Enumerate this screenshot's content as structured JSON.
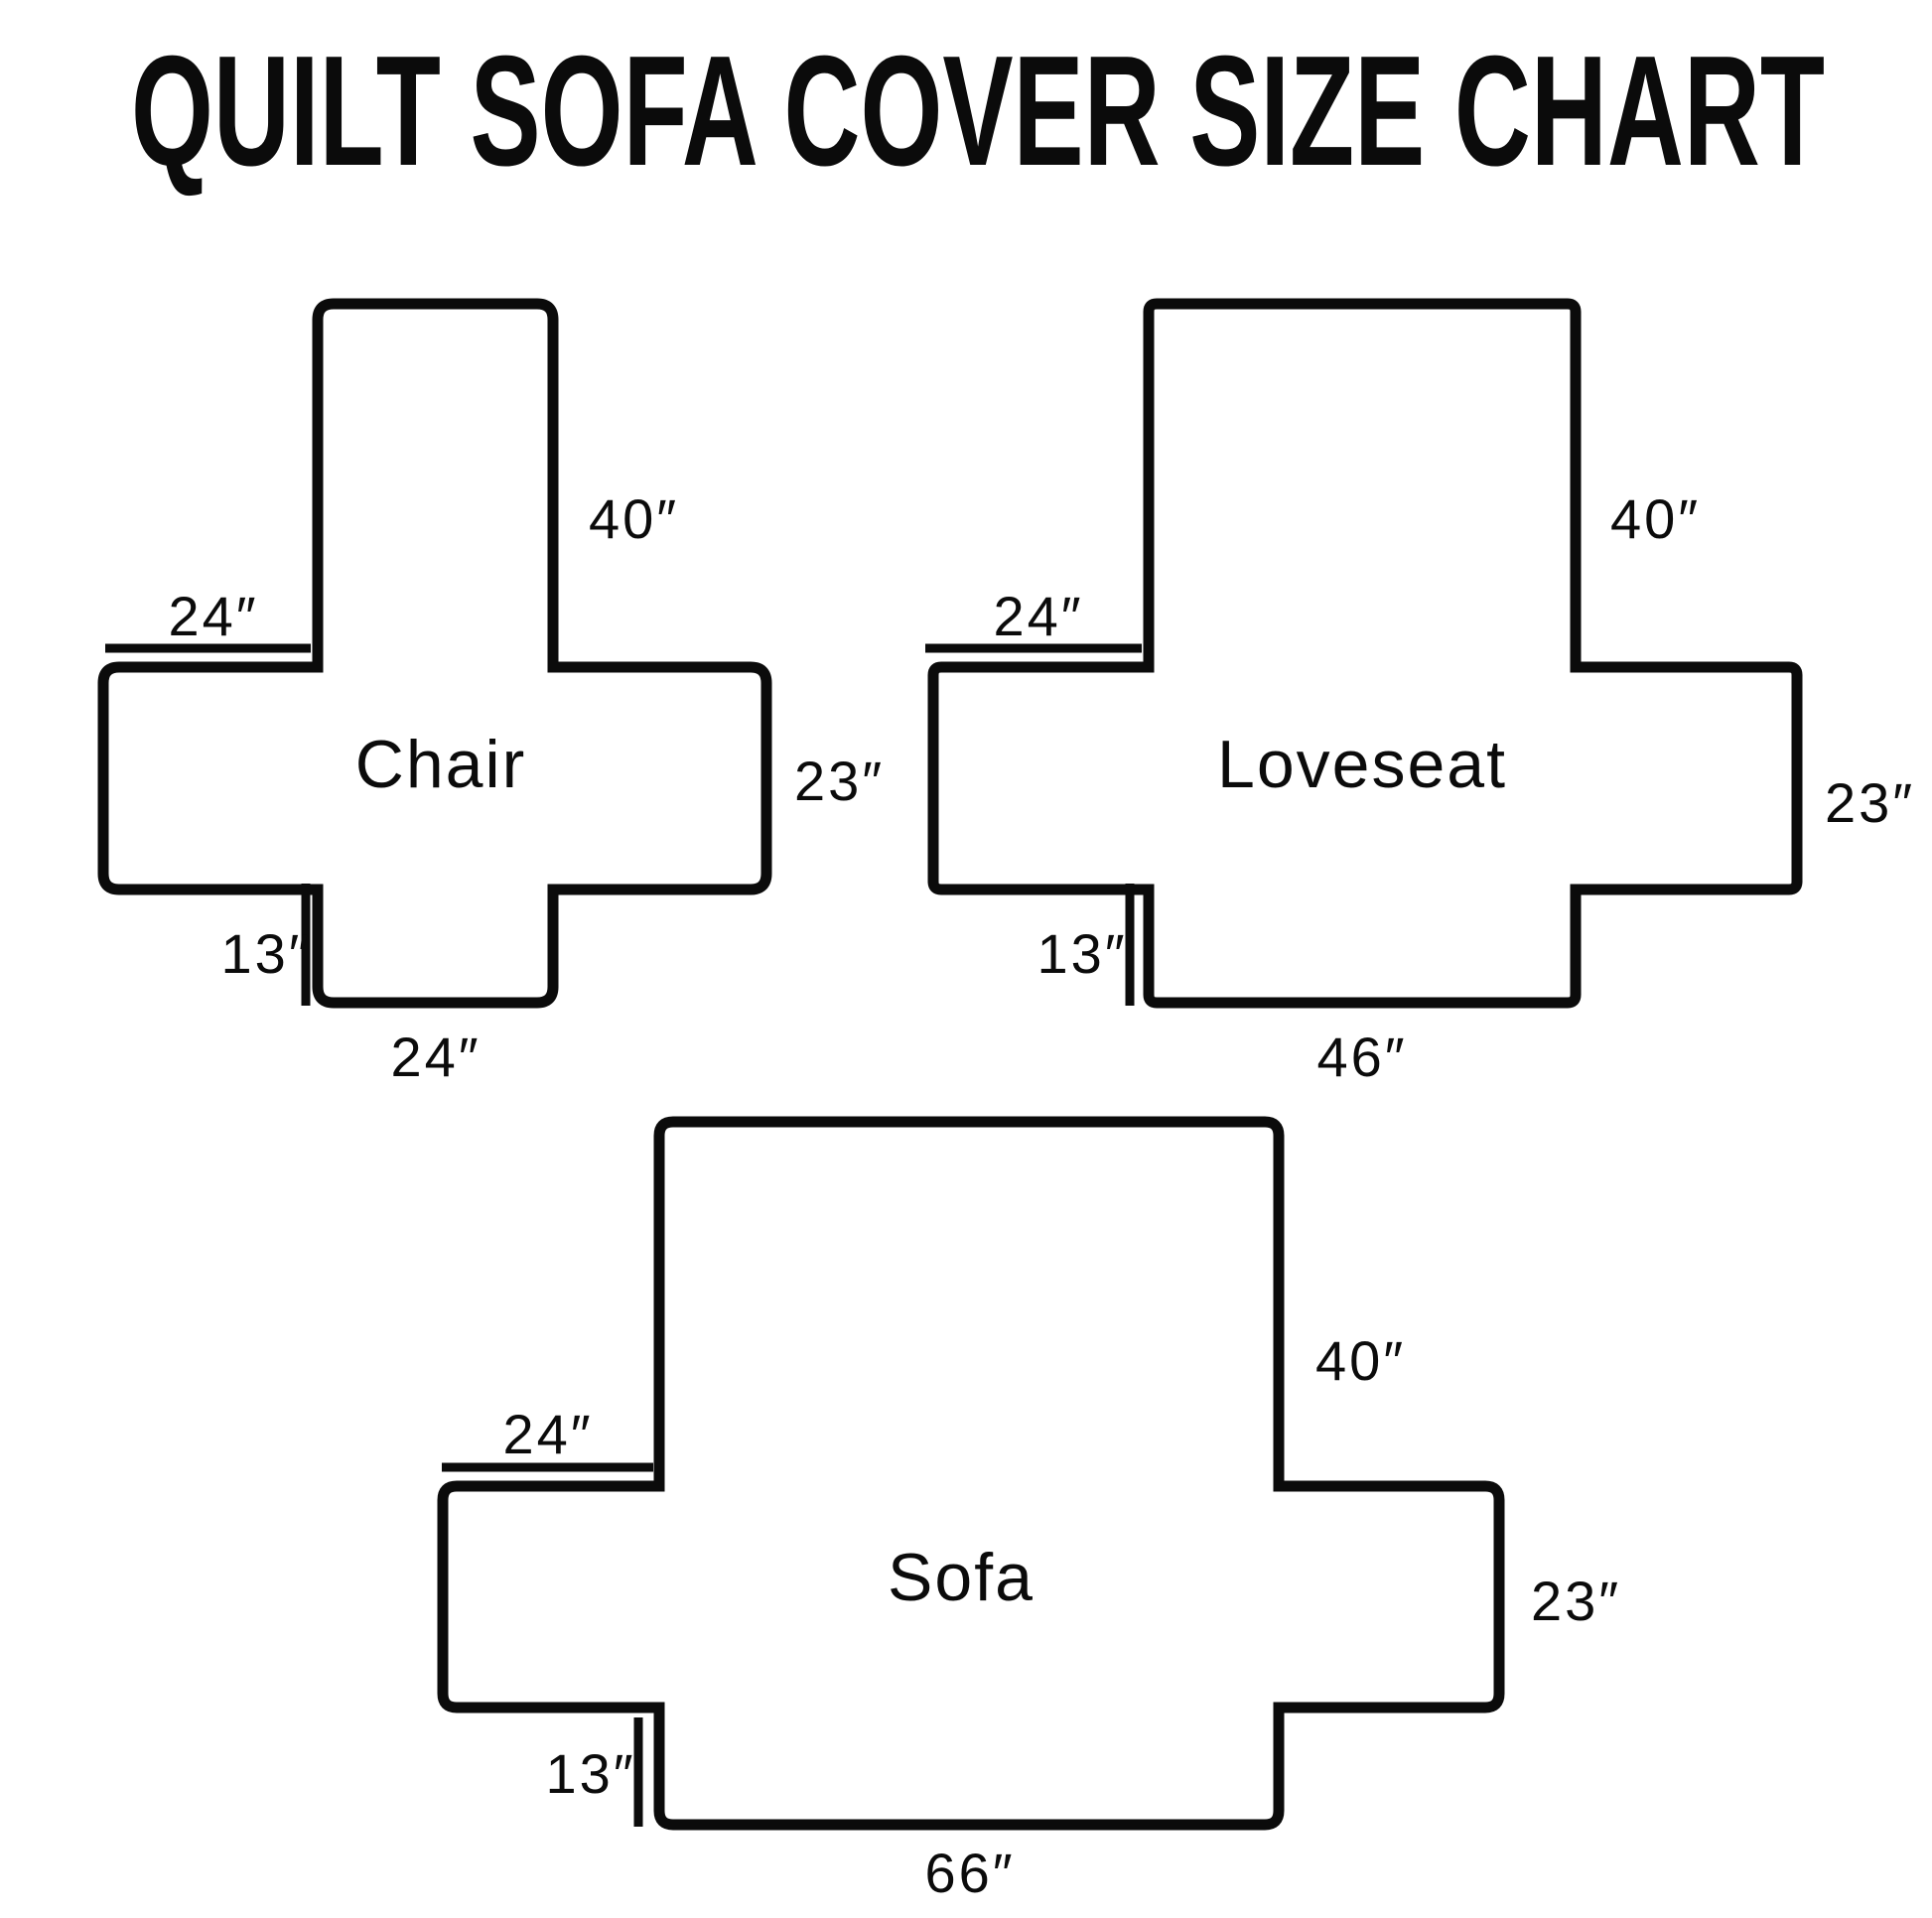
{
  "title": "QUILT SOFA COVER SIZE CHART",
  "colors": {
    "ink": "#0b0b0b",
    "background": "#ffffff"
  },
  "diagrams": {
    "chair": {
      "label": "Chair",
      "back_height": "40″",
      "arm_width": "24″",
      "side_height": "23″",
      "skirt_height": "13″",
      "bottom_width": "24″"
    },
    "loveseat": {
      "label": "Loveseat",
      "back_height": "40″",
      "arm_width": "24″",
      "side_height": "23″",
      "skirt_height": "13″",
      "bottom_width": "46″"
    },
    "sofa": {
      "label": "Sofa",
      "back_height": "40″",
      "arm_width": "24″",
      "side_height": "23″",
      "skirt_height": "13″",
      "bottom_width": "66″"
    }
  }
}
